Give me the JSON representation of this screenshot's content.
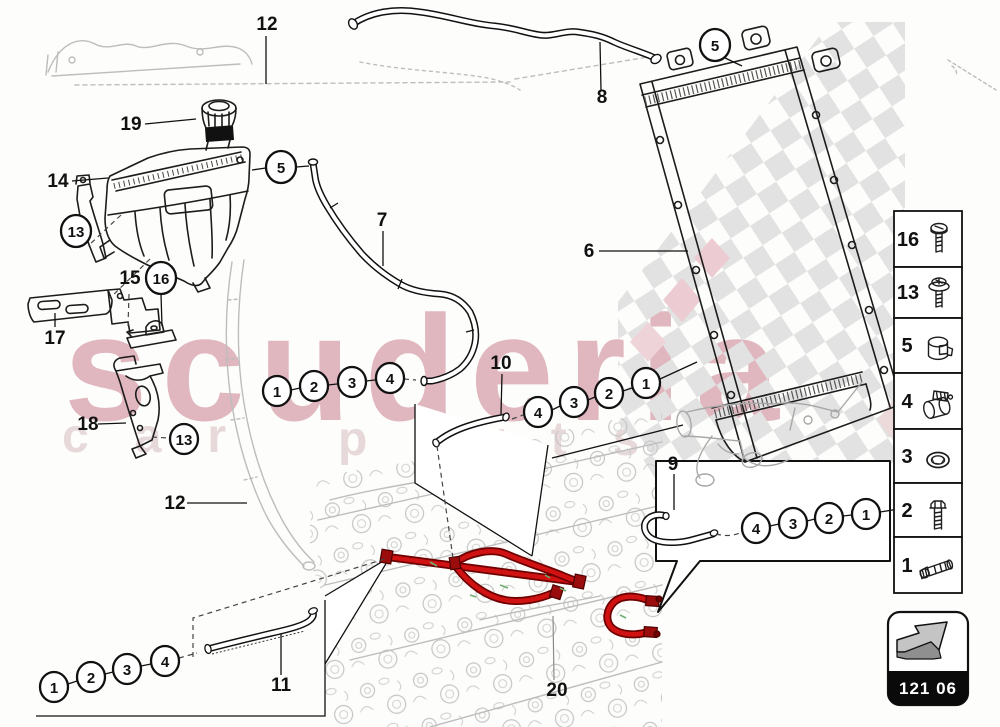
{
  "watermark": {
    "brand": "scuderia",
    "sub_left": "car",
    "sub_right": "parts",
    "pink": "#e0b7bf",
    "sub_color": "#e7d9da",
    "checker_gray": "#e2e2e2"
  },
  "part_labels": {
    "panel_top": "12",
    "cap": "19",
    "tank": "14",
    "bracket_left": "17",
    "bracket_mid": "15",
    "bracket_gusset": "18",
    "sill": "12",
    "hose_front": "7",
    "hose_top": "8",
    "radiator": "6",
    "hose_small_mid": "10",
    "hose_small_right": "9",
    "pipe_bottom": "11",
    "engine": "20"
  },
  "circle_callouts": {
    "clamp_tank": "5",
    "clamp_radiator": "5",
    "clip_left": "13",
    "clip_mid": "16",
    "clip_gusset": "13"
  },
  "callout_rows": {
    "tank_hose": [
      "1",
      "2",
      "3",
      "4"
    ],
    "mid": [
      "4",
      "3",
      "2",
      "1"
    ],
    "right": [
      "4",
      "3",
      "2",
      "1"
    ],
    "bottom": [
      "1",
      "2",
      "3",
      "4"
    ]
  },
  "legend": {
    "rows": [
      {
        "num": "16",
        "icon": "pan-head-screw"
      },
      {
        "num": "13",
        "icon": "flanged-screw"
      },
      {
        "num": "5",
        "icon": "hose-clamp"
      },
      {
        "num": "4",
        "icon": "pipe-clip"
      },
      {
        "num": "3",
        "icon": "seal-ring"
      },
      {
        "num": "2",
        "icon": "hex-bolt"
      },
      {
        "num": "1",
        "icon": "hose-fitting"
      }
    ]
  },
  "nav": {
    "code": "121 06",
    "icon": "forward-arrow"
  },
  "colors": {
    "hose_highlight": "#d01212",
    "fitting_dark": "#9b0d0d"
  }
}
